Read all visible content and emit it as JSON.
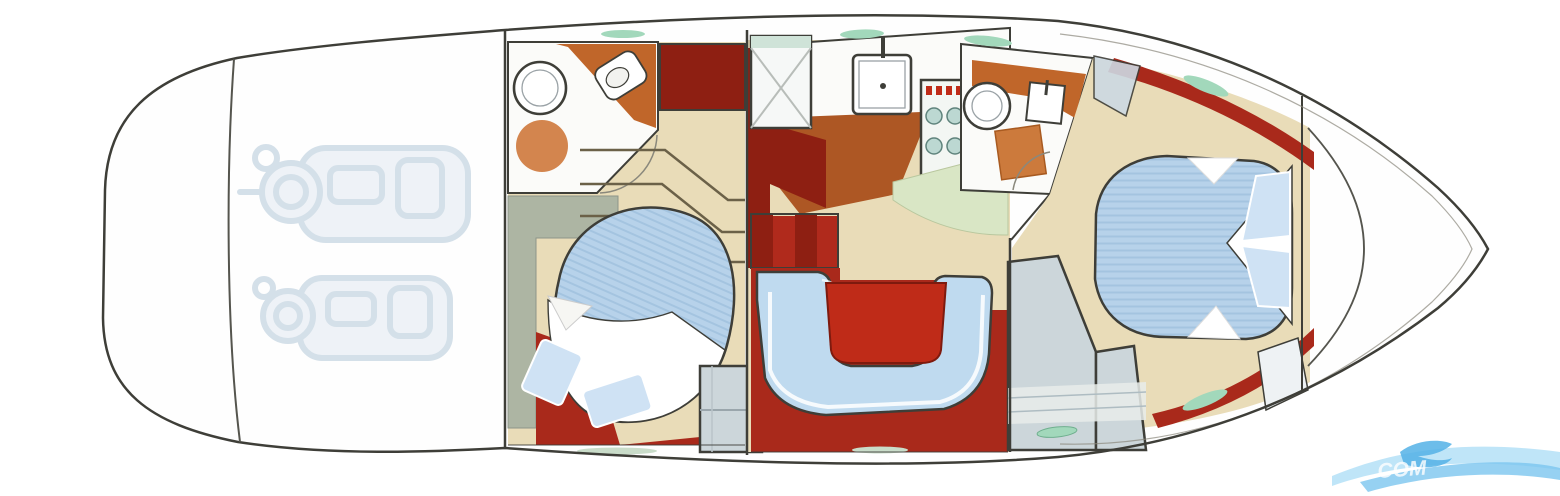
{
  "diagram": {
    "type": "yacht-interior-floor-plan",
    "orientation": "bow-right-stern-left",
    "areas": [
      {
        "id": "swim-platform",
        "label": "stern swim platform"
      },
      {
        "id": "engine-room",
        "label": "engine room with twin engines"
      },
      {
        "id": "aft-head",
        "label": "aft bathroom with sink, toilet and rug"
      },
      {
        "id": "aft-cabin",
        "label": "aft guest cabin with double berth"
      },
      {
        "id": "companionway-stairs",
        "label": "stairs down from deck"
      },
      {
        "id": "galley",
        "label": "galley with sink and stove"
      },
      {
        "id": "shower-stall",
        "label": "separate shower stall"
      },
      {
        "id": "dinette",
        "label": "U-shaped dinette sofa with table"
      },
      {
        "id": "forward-head",
        "label": "forward bathroom with vanity"
      },
      {
        "id": "master-cabin",
        "label": "forward master cabin with island berth"
      },
      {
        "id": "bow-deck",
        "label": "bow deck and anchor locker"
      }
    ]
  },
  "watermark": {
    "text": "COM"
  },
  "colors": {
    "outline": "#3e3e38",
    "line_soft": "#8a887c",
    "hull_fill": "#fefefe",
    "room_white": "#fbfbf9",
    "floor_red": "#a9291b",
    "floor_red_dark": "#8e1f12",
    "step_red": "#b02a1c",
    "table_red": "#bf2b18",
    "table_red_dark": "#7e1a0e",
    "terracotta": "#ad5724",
    "counter_orange": "#c0662a",
    "rug_orange": "#d3854e",
    "mat_orange": "#cc7a3c",
    "beige": "#e9dcb8",
    "green_floor": "#d9e6c5",
    "sage": "#adb5a3",
    "bed_blue": "#b7d2ea",
    "bed_stripe": "#a4c4e0",
    "pillow_blue": "#cfe2f4",
    "sofa_blue": "#bfdaef",
    "landing_blue": "#dce9f4",
    "locker_gray": "#ccd6da",
    "locker_light": "#e7ecea",
    "panel_blue": "#cdd9e3",
    "panel_pale": "#eef2f4",
    "window_green": "#a2d8bb",
    "deck_strip_green": "#c9dcc9",
    "shower_top_green": "#cfe3d8",
    "burner_teal": "#bcd8d2",
    "burner_rim": "#5f837c",
    "engine_ghost": "#c7d6e2",
    "engine_fill": "#e9eff5",
    "stair_line": "#6b6148",
    "white": "#ffffff",
    "wm_blue": "#7cc6ef",
    "wm_blue_light": "#a9dcf6",
    "wm_fish": "#54b2e6",
    "wm_text": "#ffffff"
  }
}
